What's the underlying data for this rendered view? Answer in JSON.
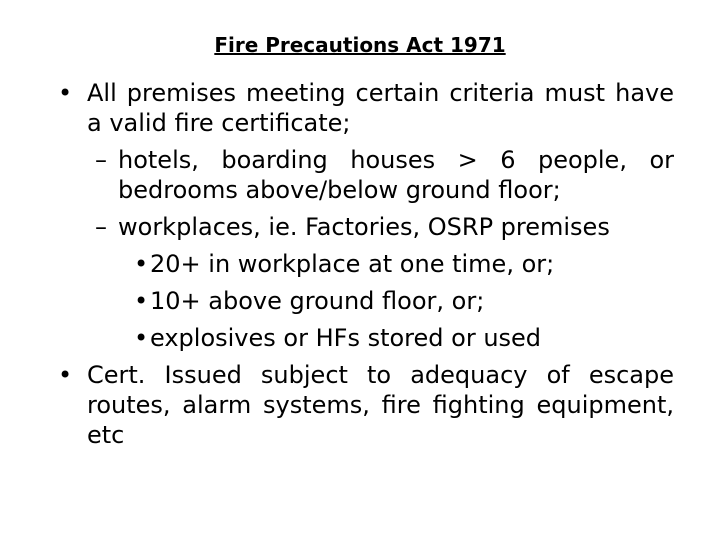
{
  "slide": {
    "title": "Fire Precautions Act 1971",
    "colors": {
      "background": "#ffffff",
      "text": "#000000"
    },
    "bullets": [
      {
        "level": 1,
        "marker": "•",
        "text": "All premises meeting certain criteria must have a valid fire certificate;"
      },
      {
        "level": 2,
        "marker": "–",
        "text": "hotels, boarding houses > 6 people, or bedrooms above/below ground floor;"
      },
      {
        "level": 2,
        "marker": "–",
        "text": "workplaces, ie. Factories, OSRP premises"
      },
      {
        "level": 3,
        "marker": "•",
        "text": "20+ in workplace at one time, or;"
      },
      {
        "level": 3,
        "marker": "•",
        "text": "10+ above ground floor, or;"
      },
      {
        "level": 3,
        "marker": "•",
        "text": "explosives or HFs stored or used"
      },
      {
        "level": 1,
        "marker": "•",
        "text": "Cert. Issued subject to adequacy of escape routes, alarm systems, fire fighting equipment, etc"
      }
    ]
  }
}
